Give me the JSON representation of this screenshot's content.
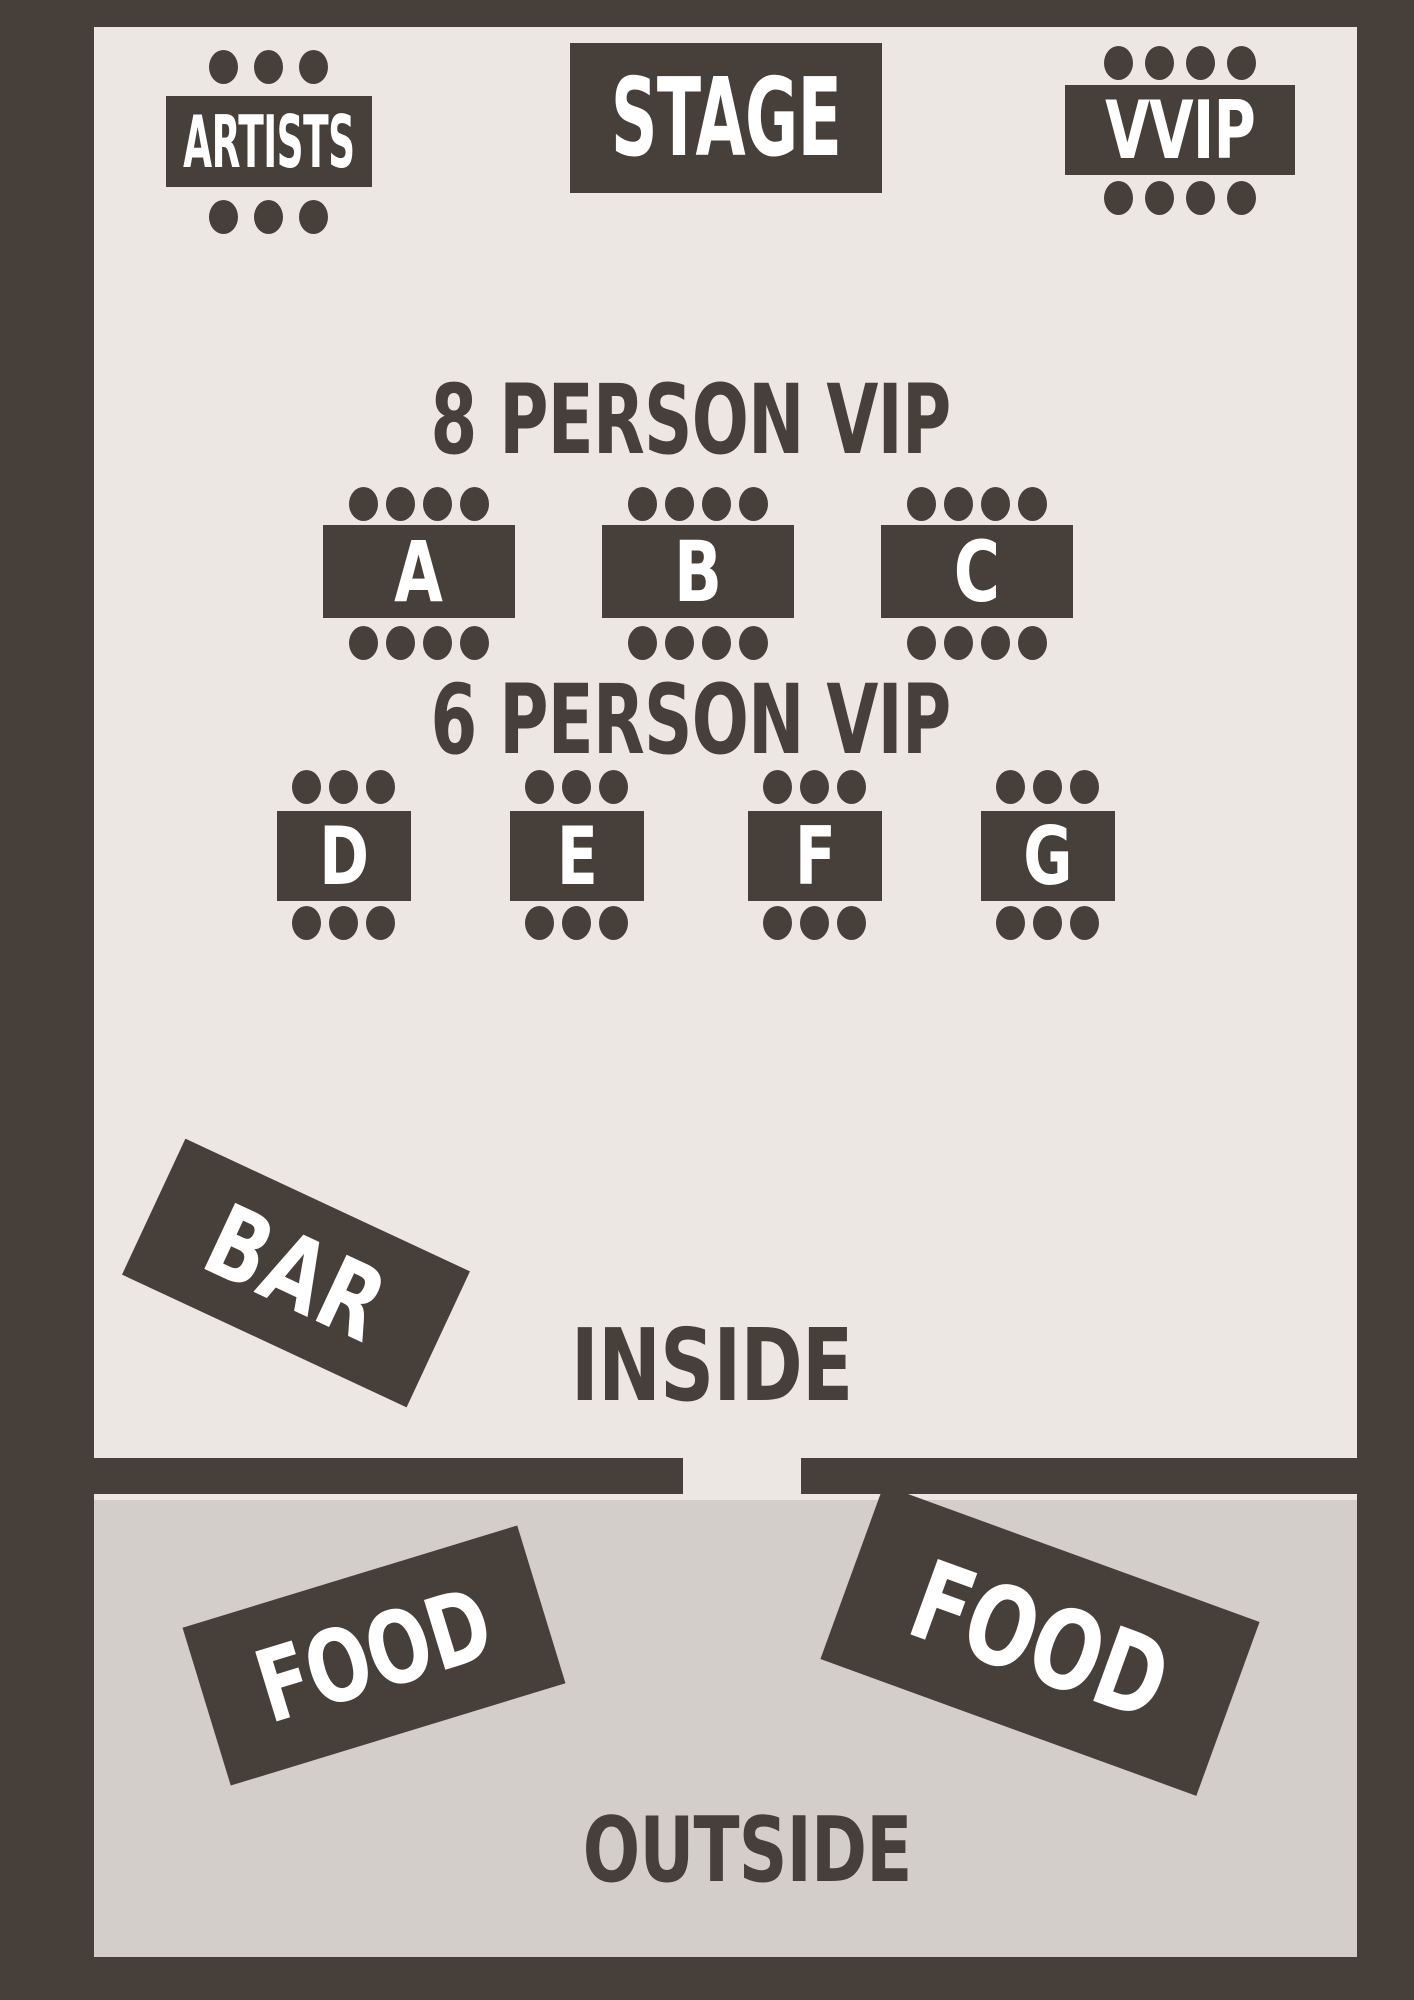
{
  "title": "Event venue seating map",
  "colors": {
    "frame_and_shapes": "#473F3A",
    "inside_background": "#EDE7E3",
    "outside_background": "#D3CEC9",
    "box_text": "#FFFFFF",
    "area_text": "#473F3A"
  },
  "top_row": {
    "artists": {
      "label": "ARTISTS",
      "seats_top": 3,
      "seats_bottom": 3
    },
    "stage": {
      "label": "STAGE"
    },
    "vvip": {
      "label": "VVIP",
      "seats_top": 4,
      "seats_bottom": 4
    }
  },
  "vip8": {
    "heading": "8 PERSON VIP",
    "tables": [
      {
        "label": "A",
        "seats_top": 4,
        "seats_bottom": 4
      },
      {
        "label": "B",
        "seats_top": 4,
        "seats_bottom": 4
      },
      {
        "label": "C",
        "seats_top": 4,
        "seats_bottom": 4
      }
    ]
  },
  "vip6": {
    "heading": "6 PERSON VIP",
    "tables": [
      {
        "label": "D",
        "seats_top": 3,
        "seats_bottom": 3
      },
      {
        "label": "E",
        "seats_top": 3,
        "seats_bottom": 3
      },
      {
        "label": "F",
        "seats_top": 3,
        "seats_bottom": 3
      },
      {
        "label": "G",
        "seats_top": 3,
        "seats_bottom": 3
      }
    ]
  },
  "inside_area": {
    "bar_label": "BAR",
    "area_label": "INSIDE"
  },
  "outside_area": {
    "food_left_label": "FOOD",
    "food_right_label": "FOOD",
    "area_label": "OUTSIDE"
  }
}
